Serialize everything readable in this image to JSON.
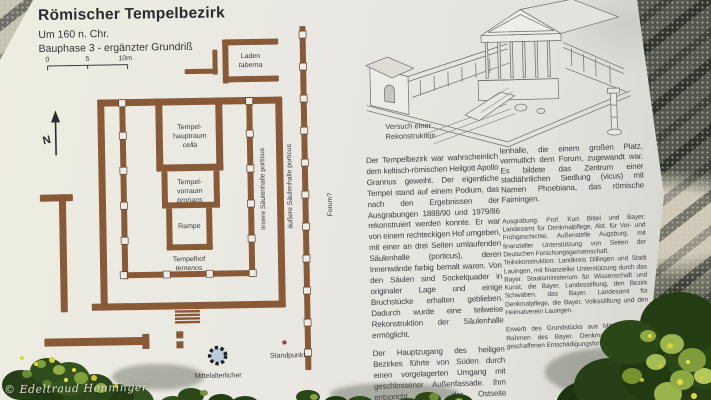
{
  "sign": {
    "title": "Römischer Tempelbezirk",
    "subtitle1": "Um 160 n. Chr.",
    "subtitle2": "Bauphase 3 - ergänzter Grundriß",
    "scale": {
      "t0": "0",
      "t5": "5",
      "t10": "10m"
    },
    "compass": "N",
    "plan": {
      "colors": {
        "wall": "#885a38",
        "column_fill": "#efece6",
        "well_fill": "#b8cddc",
        "standpoint_dot": "#9c4a36"
      },
      "labels": {
        "laden1": "Laden",
        "laden2": "taberna",
        "cella1": "Tempel-",
        "cella2": "hauptraum",
        "cella3": "cella",
        "pronaos1": "Tempel-",
        "pronaos2": "vorraum",
        "pronaos3": "pronaos",
        "rampe": "Rampe",
        "hof1": "Tempelhof",
        "hof2": "temenos",
        "innere": "innere Säulenhalle porticus",
        "aeussere": "äußere Säulenhalle porticus",
        "forum": "Forum?",
        "brunnen1": "Mittelalterlicher",
        "brunnen2": "Brunnen",
        "standpunkt": "Standpunkt"
      }
    },
    "drawing": {
      "caption1": "Versuch einer",
      "caption2": "Rekonstruktion"
    },
    "text": {
      "col1_p1": "Der Tempelbezirk war wahrscheinlich dem keltisch-römischen Heilgott Apollo Grannus geweiht. Der eigentliche Tempel stand auf einem Podium, das nach den Ergebnissen der Ausgrabungen 1888/90 und 1979/86 rekonstruiert werden konnte. Er war von einem rechteckigen Hof umgeben, mit einer an drei Seiten umlaufenden Säulenhalle (porticus), deren Innenwände farbig bemalt waren. Von den Säulen sind Sockelquader in originaler Lage und einige Bruchstücke erhalten geblieben. Dadurch wurde eine teilweise Rekonstruktion der Säulenhalle ermöglicht.",
      "col1_p2": "Der Hauptzugang des heiligen Bezirkes führte von Süden durch einen vorgelagerten Umgang mit geschlossener Außenfassade. Ihm entspricht eine der Ostseite vorgeblendete Säu-",
      "col2_p1": "lenhalle, die einem großen Platz, vermutlich dem Forum, zugewandt war. Es bildete das Zentrum einer stadtähnlichen Siedlung (vicus) mit Namen Phoebiana, das römische Faimingen.",
      "credits1": "Ausgrabung: Prof. Kurt Bittel und Bayer. Landesamt für Denkmalpflege, Abt. für Vor- und Frühgeschichte, Außenstelle Augsburg, mit finanzieller Unterstützung von Seiten der Deutschen Forschungsgemeinschaft.",
      "credits2": "Teilrekonstruktion: Landkreis Dillingen und Stadt Lauingen, mit finanzieller Unterstützung durch das Bayer. Staatsministerium für Wissenschaft und Kunst, die Bayer. Landesstiftung, den Bezirk Schwaben, das Bayer. Landesamt für Denkmalpflege, die Bayer. Volksstiftung und den Heimatverein Lauingen.",
      "credits3": "Erwerb des Grundstücks aus Mitteln des im Rahmen des Bayer. Denkmalschutzgesetzes geschaffenen Entschädigungsfonds."
    }
  },
  "watermark": "© Edeltraud Henninger"
}
